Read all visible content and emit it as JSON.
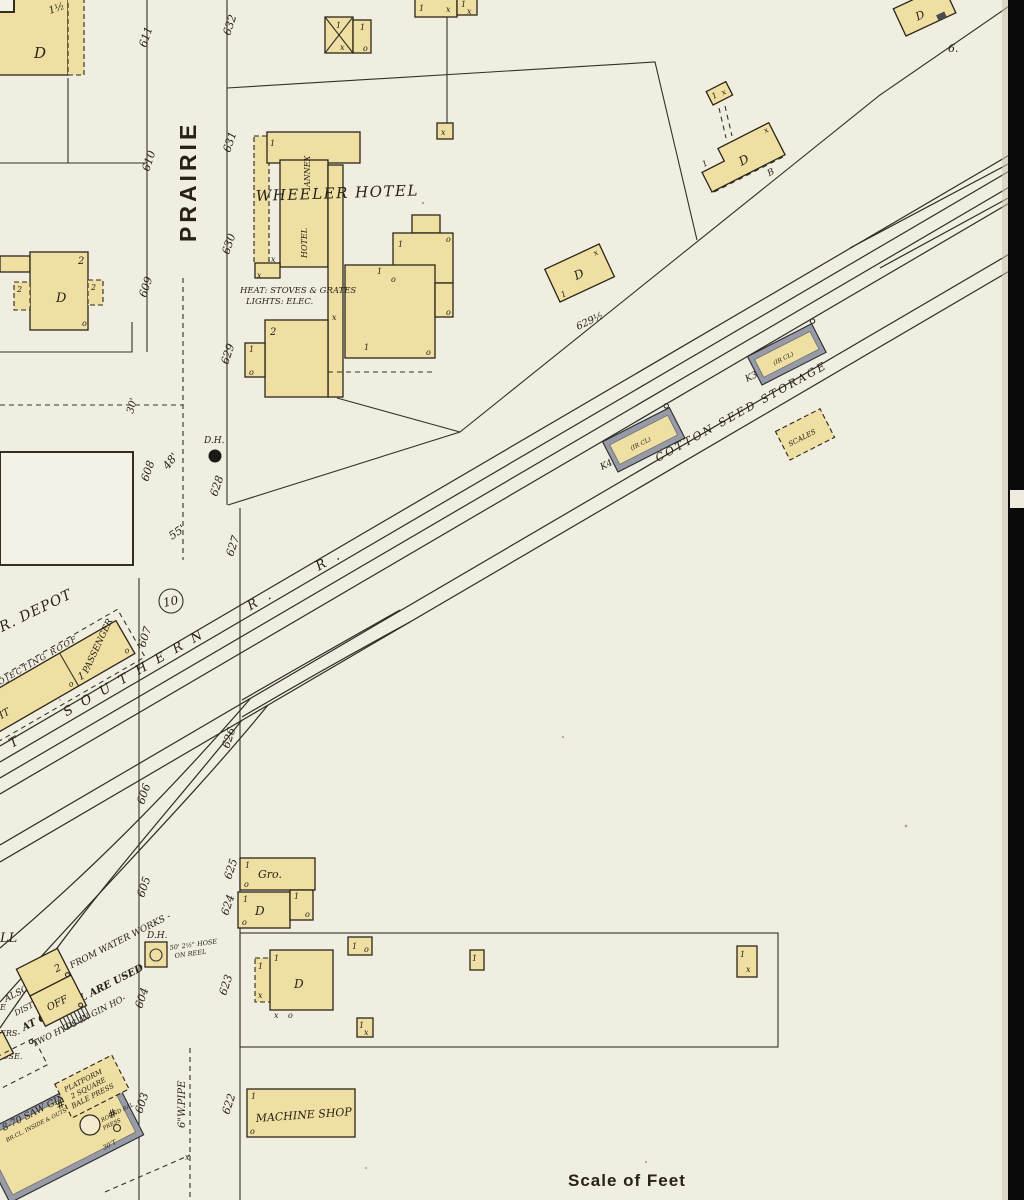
{
  "map": {
    "street_name": "PRAIRIE",
    "scale_label": "Scale of Feet",
    "block_number": "10",
    "corner_label": "6.",
    "railroad_name": "T SOUTHERN R. R."
  },
  "street_numbers": {
    "west": [
      "611",
      "610",
      "609",
      "608",
      "607",
      "606",
      "605",
      "604",
      "603"
    ],
    "east": [
      "632",
      "631",
      "630",
      "629",
      "628",
      "627",
      "626",
      "625",
      "624",
      "623",
      "622"
    ]
  },
  "hotel": {
    "name": "WHEELER HOTEL",
    "annex": "ANNEX",
    "wing": "HOTEL",
    "heat_note": "HEAT: STOVES & GRATES",
    "lights_note": "LIGHTS: ELEC."
  },
  "depot": {
    "title": "R. DEPOT",
    "roof": "PROJECTING ROOF",
    "passenger": "PASSENGER",
    "freight_partial": "GHT"
  },
  "cotton": {
    "title": "COTTON SEED STORAGE",
    "k4": "K4",
    "k3": "K3",
    "ircl": "(IR CL)",
    "scales": "SCALES"
  },
  "notes": {
    "dh": "D.H.",
    "hose1": "50' 2½\" HOSE",
    "hose2": "ON REEL",
    "pipe": "6\"W.PIPE",
    "d30": "30'",
    "d48": "48'",
    "d55": "55'",
    "addr_629half": "629½"
  },
  "shops": {
    "grocery": "Gro.",
    "machine_shop": "MACHINE SHOP"
  },
  "mill": {
    "ll": "LL",
    "line1": "ALSO - POWER FROM WATER WORKS -",
    "line2": "DISTRIBUTED.",
    "line3": "AT OIL MILL ARE USED",
    "line4": "TWO HYDS IN GIN HO-",
    "edge1": "E",
    "edge2": "ERS-",
    "edge3": "OSE.",
    "office": "OFF",
    "gins": "8-70 SAW GINS",
    "gins_note": "BR.CL. INSIDE & OUTS",
    "plat1": "PLATFORM",
    "plat2": "2 SQUARE",
    "plat3": "BALE PRESS",
    "press1": "ROUND BAL",
    "press2": "PRESS",
    "press3": "30'T"
  },
  "sym": {
    "d": "D",
    "one": "1",
    "two": "2",
    "x": "x",
    "o": "o",
    "half": "1½",
    "b": "B",
    "hash": "#"
  },
  "colors": {
    "paper": "#f0eee1",
    "building_frame": "#efdfa3",
    "iron_clad": "#979ba6",
    "ink": "#2b2517",
    "page_edge": "#0a0a0a"
  }
}
